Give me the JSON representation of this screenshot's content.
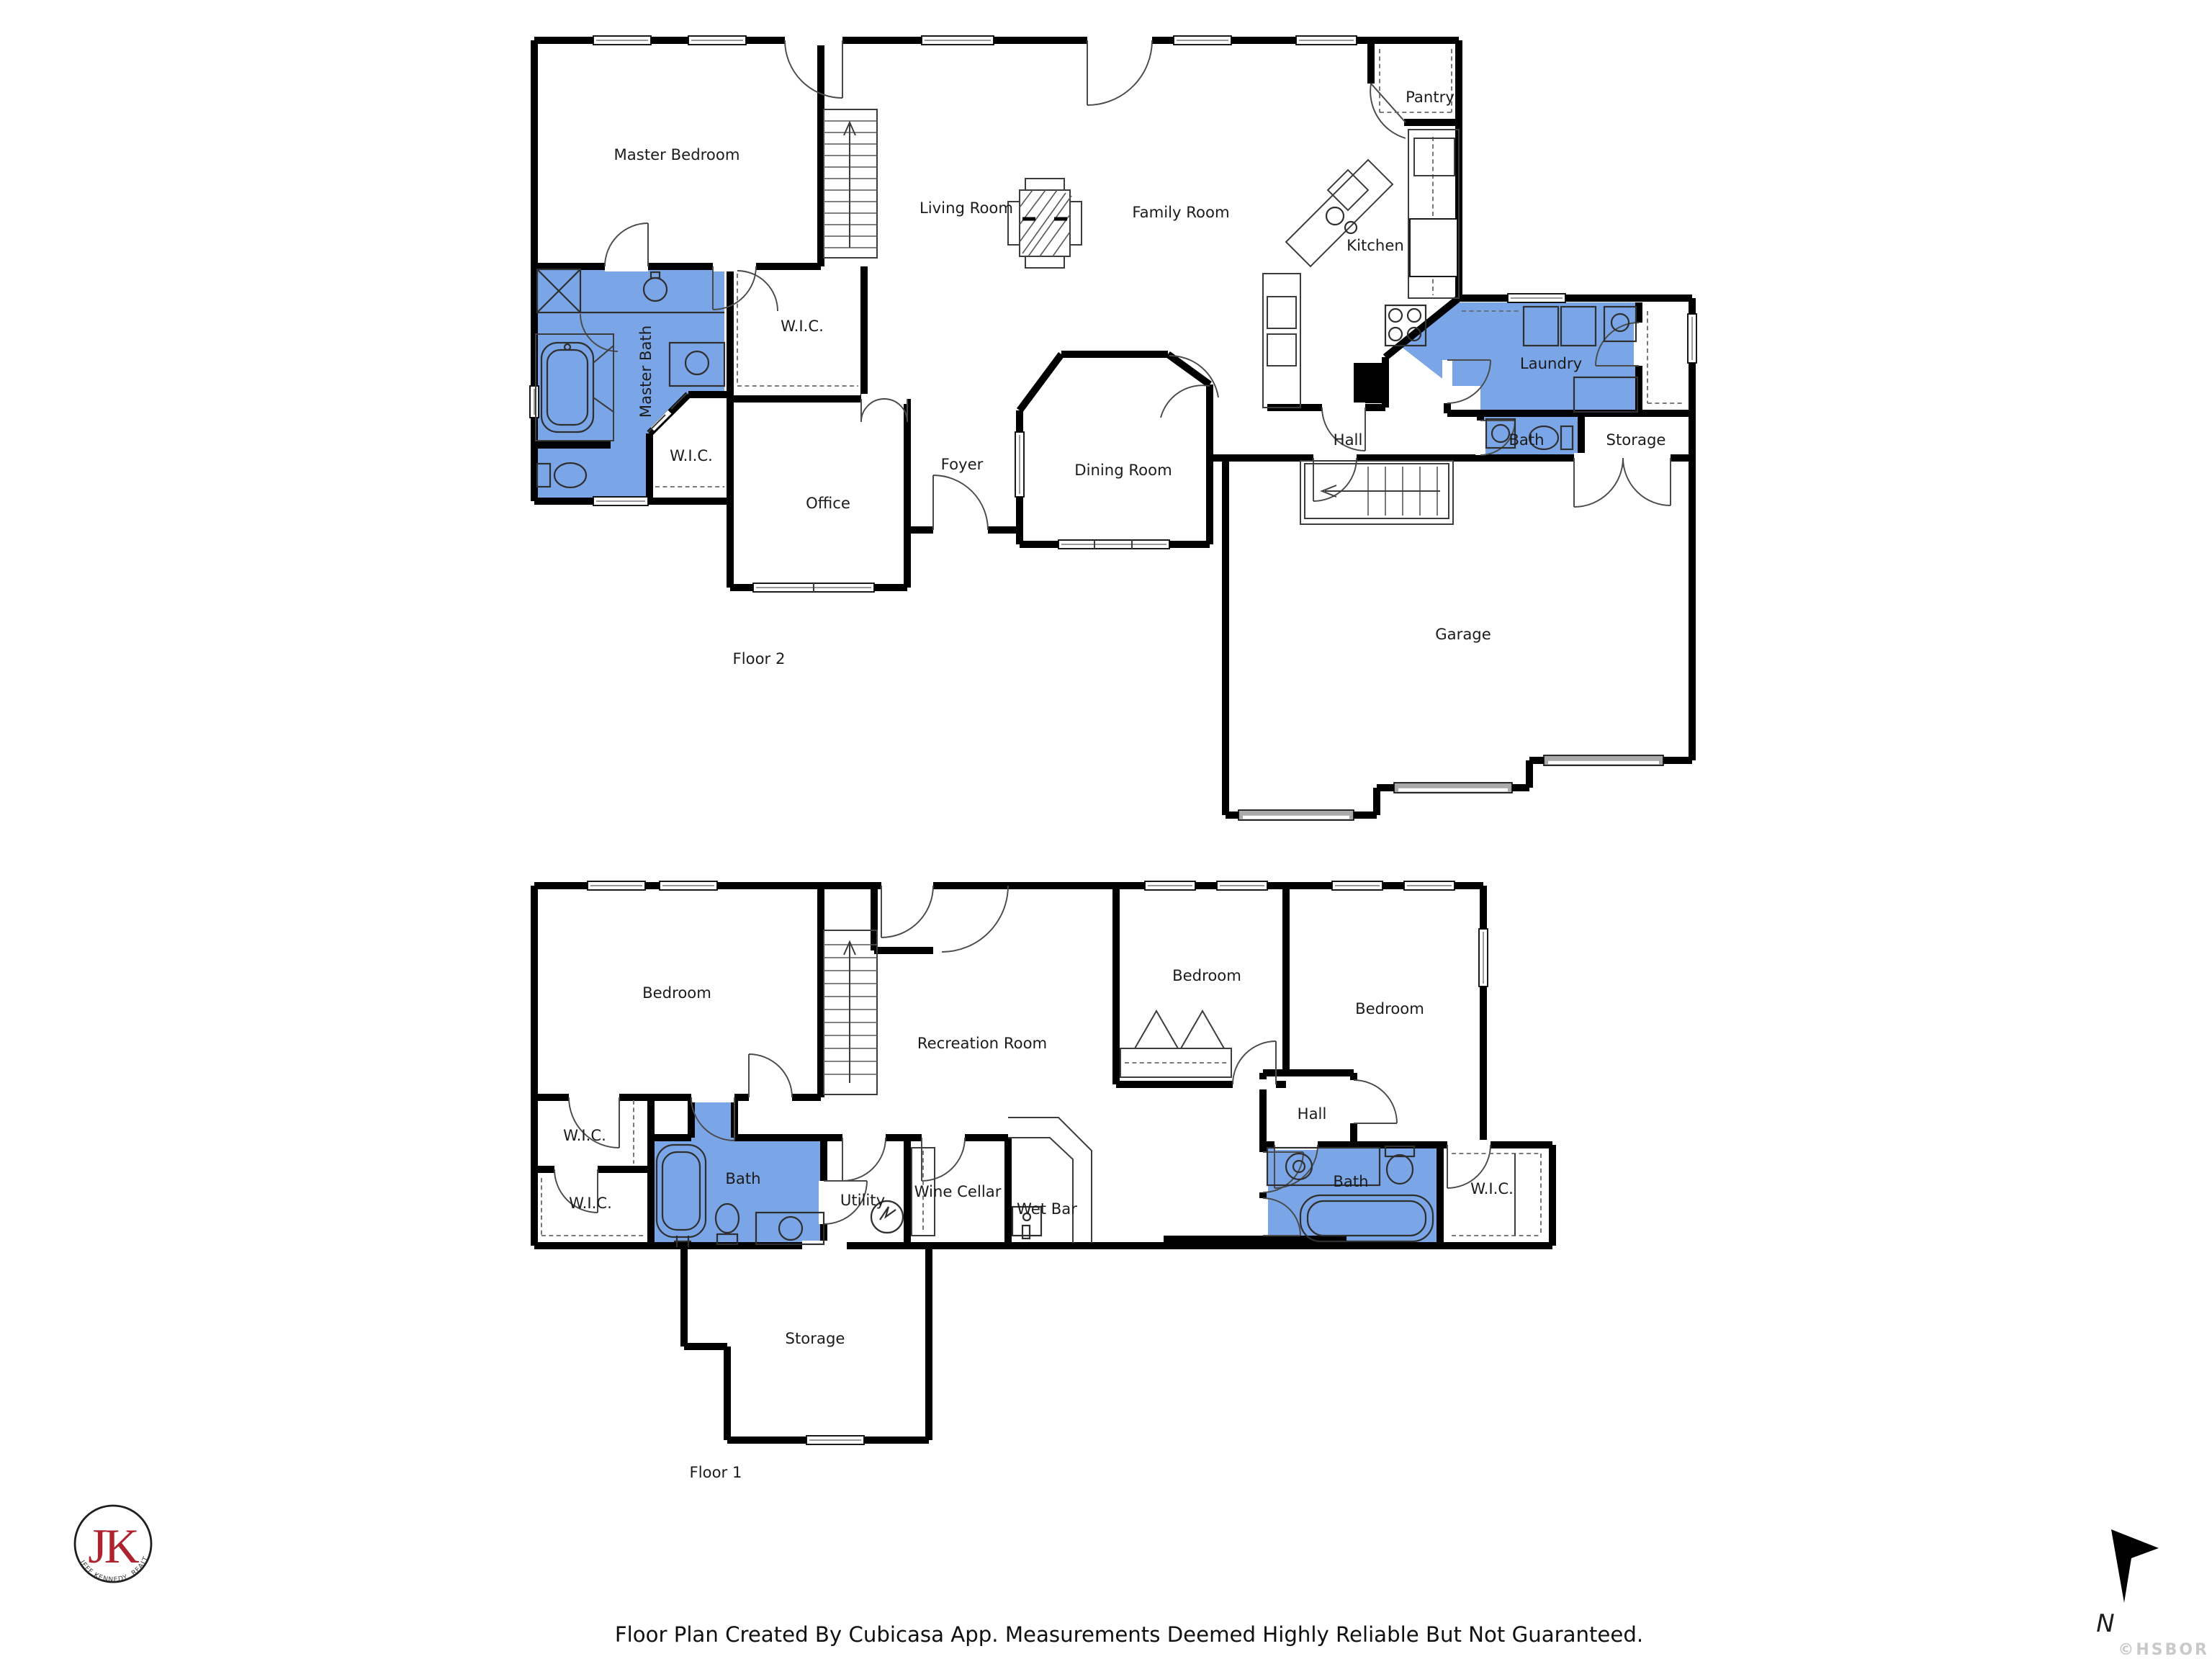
{
  "page": {
    "disclaimer": "Floor Plan Created By Cubicasa App. Measurements Deemed Highly Reliable But Not Guaranteed.",
    "watermark": "©HSBOR"
  },
  "colors": {
    "room_highlight": "#7aa5e6",
    "wall": "#000000",
    "logo_red": "#ad2330",
    "watermark_gray": "#c9c9c9"
  },
  "logo": {
    "initials": "JK",
    "tagline": "JEFF KENNEDY, REALTOR®"
  },
  "compass": {
    "north_label": "N"
  },
  "floor2": {
    "caption": "Floor 2",
    "rooms": {
      "master_bedroom": "Master Bedroom",
      "living_room": "Living Room",
      "family_room": "Family Room",
      "kitchen": "Kitchen",
      "pantry": "Pantry",
      "wic_upper": "W.I.C.",
      "master_bath": "Master Bath",
      "wic_lower": "W.I.C.",
      "office": "Office",
      "foyer": "Foyer",
      "dining_room": "Dining Room",
      "hall": "Hall",
      "laundry": "Laundry",
      "bath": "Bath",
      "storage": "Storage",
      "garage": "Garage"
    }
  },
  "floor1": {
    "caption": "Floor 1",
    "rooms": {
      "bedroom_left": "Bedroom",
      "recreation_room": "Recreation Room",
      "bedroom_middle": "Bedroom",
      "bedroom_right": "Bedroom",
      "hall": "Hall",
      "wic_upper": "W.I.C.",
      "wic_lower": "W.I.C.",
      "bath_left": "Bath",
      "utility": "Utility",
      "wine_cellar": "Wine Cellar",
      "wet_bar": "Wet Bar",
      "bath_right": "Bath",
      "wic_right": "W.I.C.",
      "storage": "Storage"
    }
  }
}
